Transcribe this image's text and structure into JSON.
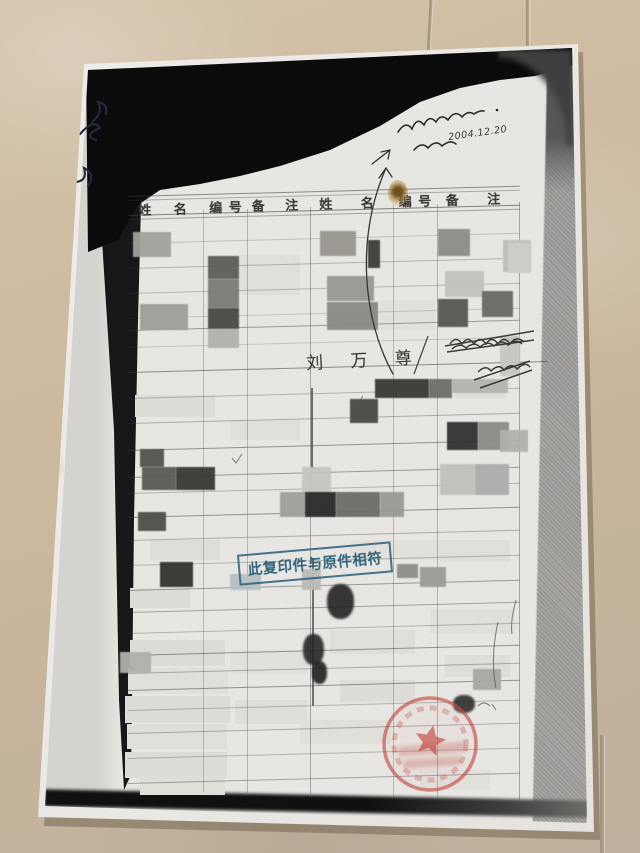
{
  "document": {
    "table_headers": [
      "姓 名",
      "编 号",
      "备 注",
      "姓 名",
      "编 号",
      "备 注"
    ],
    "handwritten_name": "刘 万 尊",
    "handwritten_date": "2004.12.20",
    "blue_stamp": {
      "text": "此复印件与原件相符",
      "color": "#265e7a"
    },
    "red_seal": {
      "shape": "circle-with-star",
      "color": "#c04e48"
    },
    "ink_color_annotations": "#2e2c2a",
    "paper_color": "#e8e6e2",
    "floor_color": "#cdbaa0"
  },
  "patches": [
    [
      240,
      255,
      60,
      40,
      "#e1dfda"
    ],
    [
      380,
      300,
      55,
      30,
      "#e2e0db"
    ],
    [
      135,
      395,
      80,
      22,
      "#dedcd7"
    ],
    [
      230,
      420,
      70,
      20,
      "#e0ded9"
    ],
    [
      455,
      380,
      50,
      18,
      "#dfddd8"
    ],
    [
      150,
      540,
      70,
      20,
      "#dfddd8"
    ],
    [
      350,
      540,
      90,
      20,
      "#e2e0db"
    ],
    [
      440,
      540,
      70,
      22,
      "#e0ded9"
    ],
    [
      130,
      588,
      60,
      20,
      "#dedcd7"
    ],
    [
      130,
      640,
      95,
      26,
      "#dddbd6"
    ],
    [
      128,
      668,
      100,
      26,
      "#e1dfda"
    ],
    [
      125,
      696,
      105,
      27,
      "#dedcd7"
    ],
    [
      127,
      724,
      100,
      25,
      "#e0ded9"
    ],
    [
      125,
      752,
      102,
      26,
      "#dddbd6"
    ],
    [
      230,
      650,
      78,
      24,
      "#e2e0db"
    ],
    [
      235,
      700,
      72,
      24,
      "#dfddd8"
    ],
    [
      330,
      630,
      85,
      24,
      "#e0ded9"
    ],
    [
      340,
      680,
      75,
      22,
      "#dedcd7"
    ],
    [
      430,
      610,
      85,
      24,
      "#e1dfda"
    ],
    [
      445,
      655,
      65,
      22,
      "#dfddd8"
    ],
    [
      300,
      720,
      90,
      24,
      "#e1dfda"
    ],
    [
      140,
      775,
      85,
      20,
      "#e0ded9"
    ],
    [
      420,
      770,
      70,
      20,
      "#e2e0db"
    ]
  ],
  "redactions": [
    [
      133,
      232,
      38,
      25,
      "#a3a19d"
    ],
    [
      320,
      231,
      36,
      25,
      "#98968f"
    ],
    [
      438,
      229,
      32,
      27,
      "#8e8c88"
    ],
    [
      503,
      240,
      28,
      32,
      "#c1bfbb"
    ],
    [
      208,
      256,
      31,
      23,
      "#5e5c58"
    ],
    [
      208,
      279,
      31,
      29,
      "#7d7b77"
    ],
    [
      208,
      308,
      31,
      21,
      "#4b4946"
    ],
    [
      208,
      329,
      31,
      19,
      "#b3b1ad"
    ],
    [
      327,
      276,
      47,
      25,
      "#9a9892"
    ],
    [
      368,
      240,
      12,
      28,
      "#3f3d3a"
    ],
    [
      445,
      271,
      39,
      26,
      "#c4c2be"
    ],
    [
      482,
      291,
      31,
      26,
      "#6b6965"
    ],
    [
      438,
      299,
      30,
      28,
      "#585650"
    ],
    [
      140,
      304,
      48,
      26,
      "#a09e99"
    ],
    [
      327,
      302,
      51,
      28,
      "#8b8984"
    ],
    [
      508,
      243,
      22,
      30,
      "#cfcdc9"
    ],
    [
      375,
      379,
      54,
      19,
      "#3b3936"
    ],
    [
      429,
      379,
      23,
      19,
      "#6f6d69"
    ],
    [
      452,
      379,
      56,
      14,
      "#b6b4b0"
    ],
    [
      350,
      399,
      28,
      24,
      "#4a4845"
    ],
    [
      447,
      422,
      31,
      28,
      "#343230"
    ],
    [
      478,
      422,
      31,
      28,
      "#8d8b87"
    ],
    [
      500,
      430,
      28,
      22,
      "#b2b0ac"
    ],
    [
      140,
      449,
      24,
      18,
      "#555350"
    ],
    [
      142,
      467,
      34,
      23,
      "#5c5a56"
    ],
    [
      176,
      467,
      39,
      23,
      "#3b3936"
    ],
    [
      302,
      467,
      29,
      26,
      "#c7c5c1"
    ],
    [
      440,
      464,
      35,
      31,
      "#c3c1bd"
    ],
    [
      475,
      464,
      34,
      31,
      "#afadab"
    ],
    [
      280,
      492,
      25,
      25,
      "#a19f9b"
    ],
    [
      305,
      492,
      31,
      25,
      "#2c2a28"
    ],
    [
      336,
      492,
      44,
      25,
      "#6d6b67"
    ],
    [
      380,
      492,
      24,
      25,
      "#9b9995"
    ],
    [
      138,
      512,
      28,
      19,
      "#504e4a"
    ],
    [
      160,
      562,
      33,
      25,
      "#353330"
    ],
    [
      230,
      574,
      31,
      16,
      "#b7c0c4"
    ],
    [
      302,
      569,
      19,
      21,
      "#bdbbb7"
    ],
    [
      397,
      564,
      21,
      14,
      "#908e8a"
    ],
    [
      420,
      567,
      26,
      20,
      "#9d9b97"
    ],
    [
      473,
      669,
      28,
      21,
      "#a9a7a3"
    ],
    [
      120,
      652,
      31,
      21,
      "#b1afab"
    ],
    [
      500,
      336,
      20,
      40,
      "#c8c6c2"
    ]
  ],
  "blotches": [
    [
      327,
      584,
      27,
      35,
      "#1f1d1b"
    ],
    [
      303,
      634,
      21,
      31,
      "#242220"
    ],
    [
      312,
      661,
      15,
      23,
      "#1c1a18"
    ],
    [
      453,
      695,
      22,
      18,
      "#2a2826"
    ]
  ],
  "grid": {
    "rows": [
      [
        196,
        0.55
      ],
      [
        200,
        0.35
      ],
      [
        215,
        0.6
      ],
      [
        219,
        0.4
      ],
      [
        243,
        0.22
      ],
      [
        268,
        0.3
      ],
      [
        293,
        0.28
      ],
      [
        318,
        0.2
      ],
      [
        330,
        0.45
      ],
      [
        347,
        0.2
      ],
      [
        372,
        0.55,
        420
      ],
      [
        398,
        0.3
      ],
      [
        423,
        0.35
      ],
      [
        450,
        0.5
      ],
      [
        477,
        0.45
      ],
      [
        493,
        0.3
      ],
      [
        517,
        0.5
      ],
      [
        540,
        0.35
      ],
      [
        565,
        0.3
      ],
      [
        590,
        0.45
      ],
      [
        612,
        0.4
      ],
      [
        633,
        0.3
      ],
      [
        655,
        0.5
      ],
      [
        673,
        0.35
      ],
      [
        690,
        0.5
      ],
      [
        710,
        0.3
      ],
      [
        733,
        0.35
      ],
      [
        758,
        0.3
      ],
      [
        783,
        0.4
      ]
    ],
    "cols": [
      [
        203,
        210,
        792,
        0.3,
        1
      ],
      [
        247,
        209,
        793,
        0.32,
        1
      ],
      [
        310,
        207,
        794,
        0.42,
        1
      ],
      [
        393,
        205,
        796,
        0.3,
        1
      ],
      [
        437,
        204,
        797,
        0.34,
        1
      ],
      [
        519,
        202,
        800,
        0.42,
        1
      ],
      [
        311,
        388,
        470,
        0.8,
        2
      ],
      [
        312,
        558,
        706,
        0.75,
        2
      ]
    ]
  }
}
